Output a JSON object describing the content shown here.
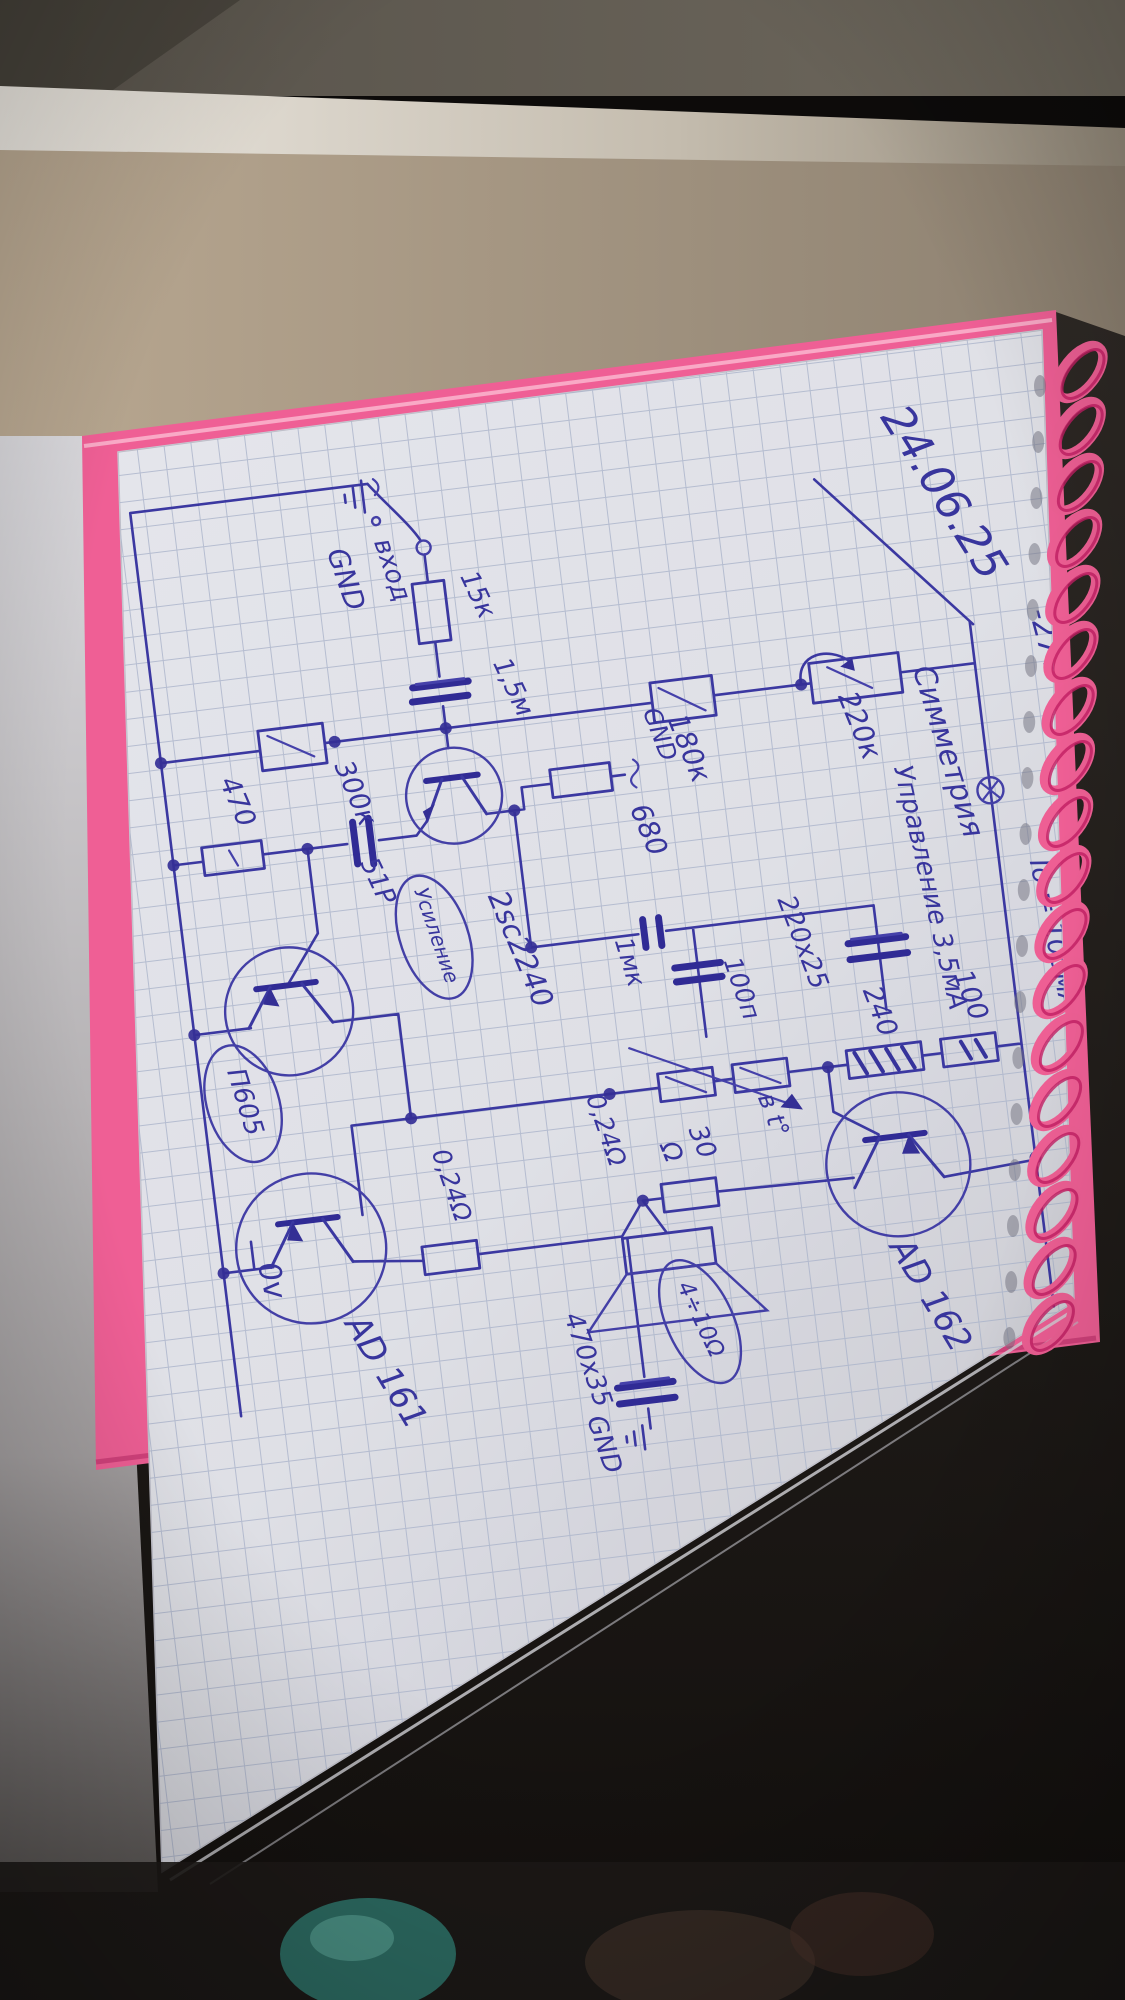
{
  "schematic": {
    "date": "24.06.25",
    "title_symmetry": "Симметрия",
    "gain_label": "Усиление",
    "control_current": "Управление 3,5мА",
    "quiescent_current": "Iо = 100мА",
    "supply_neg": "-27v",
    "supply_zero": "0v",
    "input_label": "вход",
    "input_gnd": "GND",
    "driver_gnd": "GND",
    "output_gnd": "GND",
    "thermal": "в t°",
    "speaker_impedance": "4÷10Ω",
    "transistors": {
      "q1": "2sc2240",
      "q2": "AD 162",
      "q3": "П605",
      "q4": "AD 161"
    },
    "resistors": {
      "r15k": "15к",
      "r180k": "180к",
      "r220k": "220к",
      "r300k": "300к",
      "r680": "680",
      "r470": "470",
      "r100": "100",
      "r240": "240",
      "r30": "30",
      "r30_unit": "Ω",
      "r024_top": "0,24Ω",
      "r024_bot": "0,24Ω"
    },
    "capacitors": {
      "c1u5": "1,5м",
      "c51p": "51Р",
      "c1u": "1мк",
      "c100p": "100п",
      "c220x25": "220х25",
      "c470x35": "470х35"
    }
  },
  "colors": {
    "ink": "#3f3caa",
    "paper": "#f3f4f7",
    "cover_pink": "#ef5f95",
    "wall": "#b3a28d"
  }
}
